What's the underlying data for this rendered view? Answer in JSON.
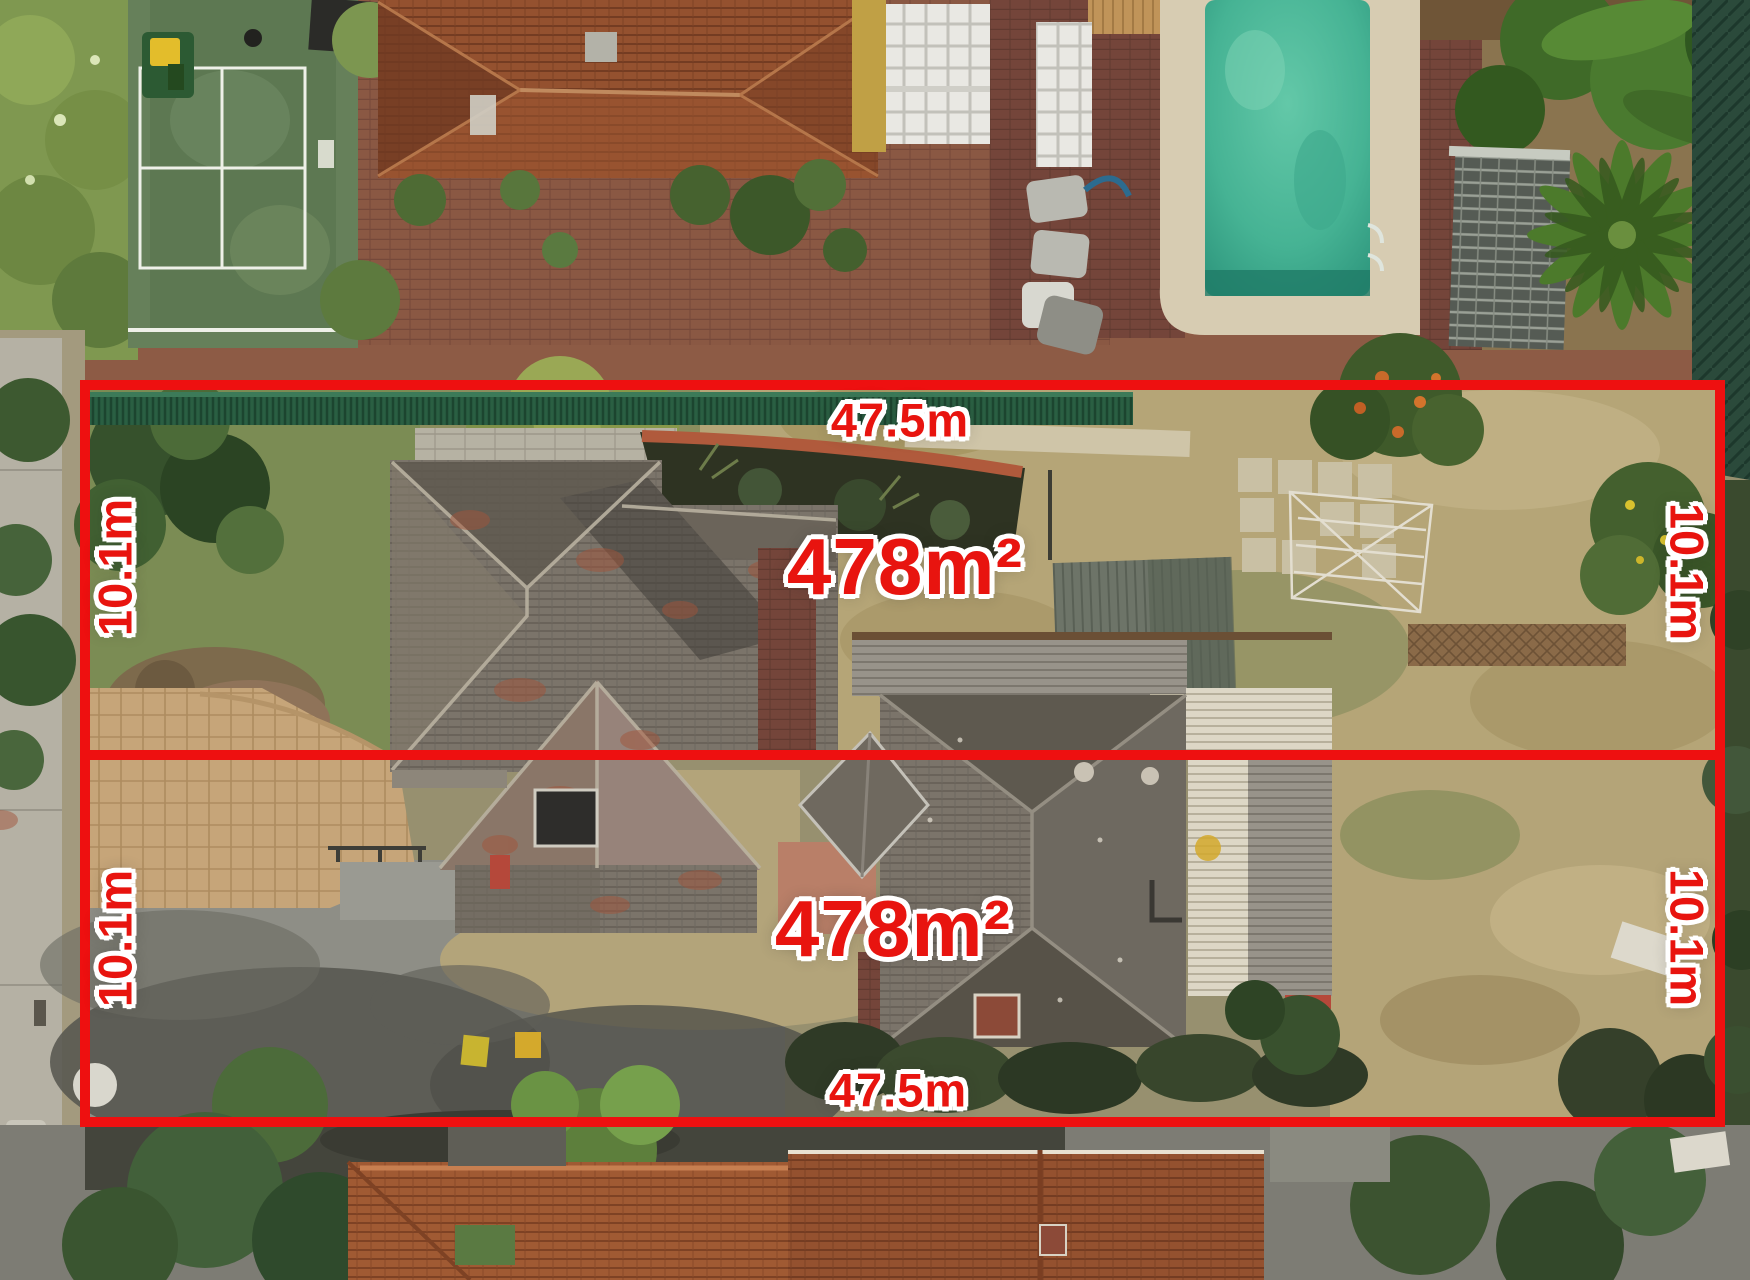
{
  "annotations": {
    "line_color": "#ee1010",
    "label_color": "#e8140f",
    "outline_color": "#ffffff",
    "lots": [
      {
        "id": "front-lot",
        "area": "478m²",
        "frontage": "47.5m",
        "depth_left": "10.1m",
        "depth_right": "10.1m"
      },
      {
        "id": "rear-lot",
        "area": "478m²",
        "frontage": "47.5m",
        "depth_left": "10.1m",
        "depth_right": "10.1m"
      }
    ]
  }
}
